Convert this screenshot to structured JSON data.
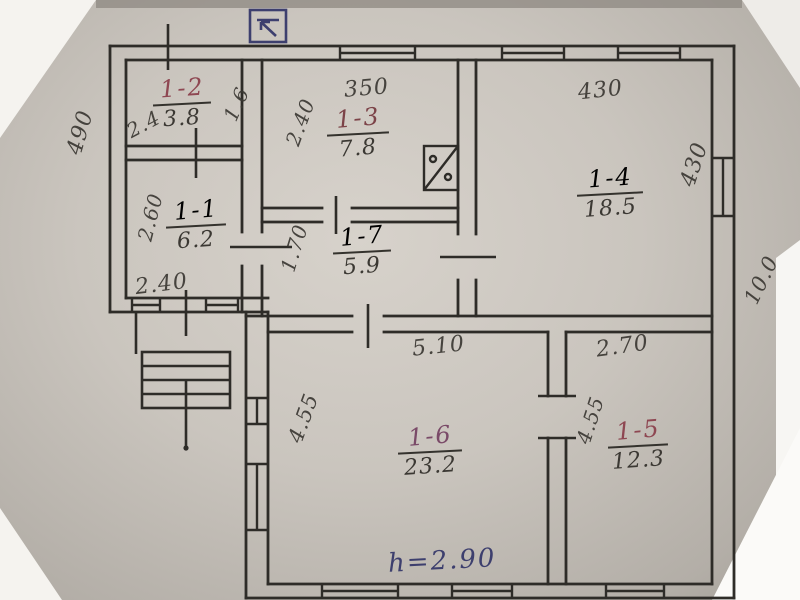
{
  "plan": {
    "kind": "hand-drawn floor plan photo",
    "height_note": "h=2.90",
    "outside_dimensions": {
      "left": "490",
      "right": "10.0"
    },
    "rooms": [
      {
        "id": "1-2",
        "area": "3.8",
        "dims": [
          "2.4",
          "1.6"
        ]
      },
      {
        "id": "1-1",
        "area": "6.2",
        "dims": [
          "2.60",
          "2.40"
        ]
      },
      {
        "id": "1-3",
        "area": "7.8",
        "dims": [
          "350",
          "2.40"
        ]
      },
      {
        "id": "1-4",
        "area": "18.5",
        "dims": [
          "430",
          "430"
        ]
      },
      {
        "id": "1-7",
        "area": "5.9",
        "dims": [
          "1.70"
        ]
      },
      {
        "id": "1-6",
        "area": "23.2",
        "dims": [
          "5.10",
          "4.55"
        ]
      },
      {
        "id": "1-5",
        "area": "12.3",
        "dims": [
          "2.70",
          "4.55"
        ]
      }
    ],
    "symbols": {
      "north": "north-arrow",
      "stove": "stove",
      "steps": "entrance-steps"
    },
    "ink_colors": {
      "pencil": "#3b3833",
      "red": "#8e4752",
      "blue": "#3d3f6e"
    }
  }
}
